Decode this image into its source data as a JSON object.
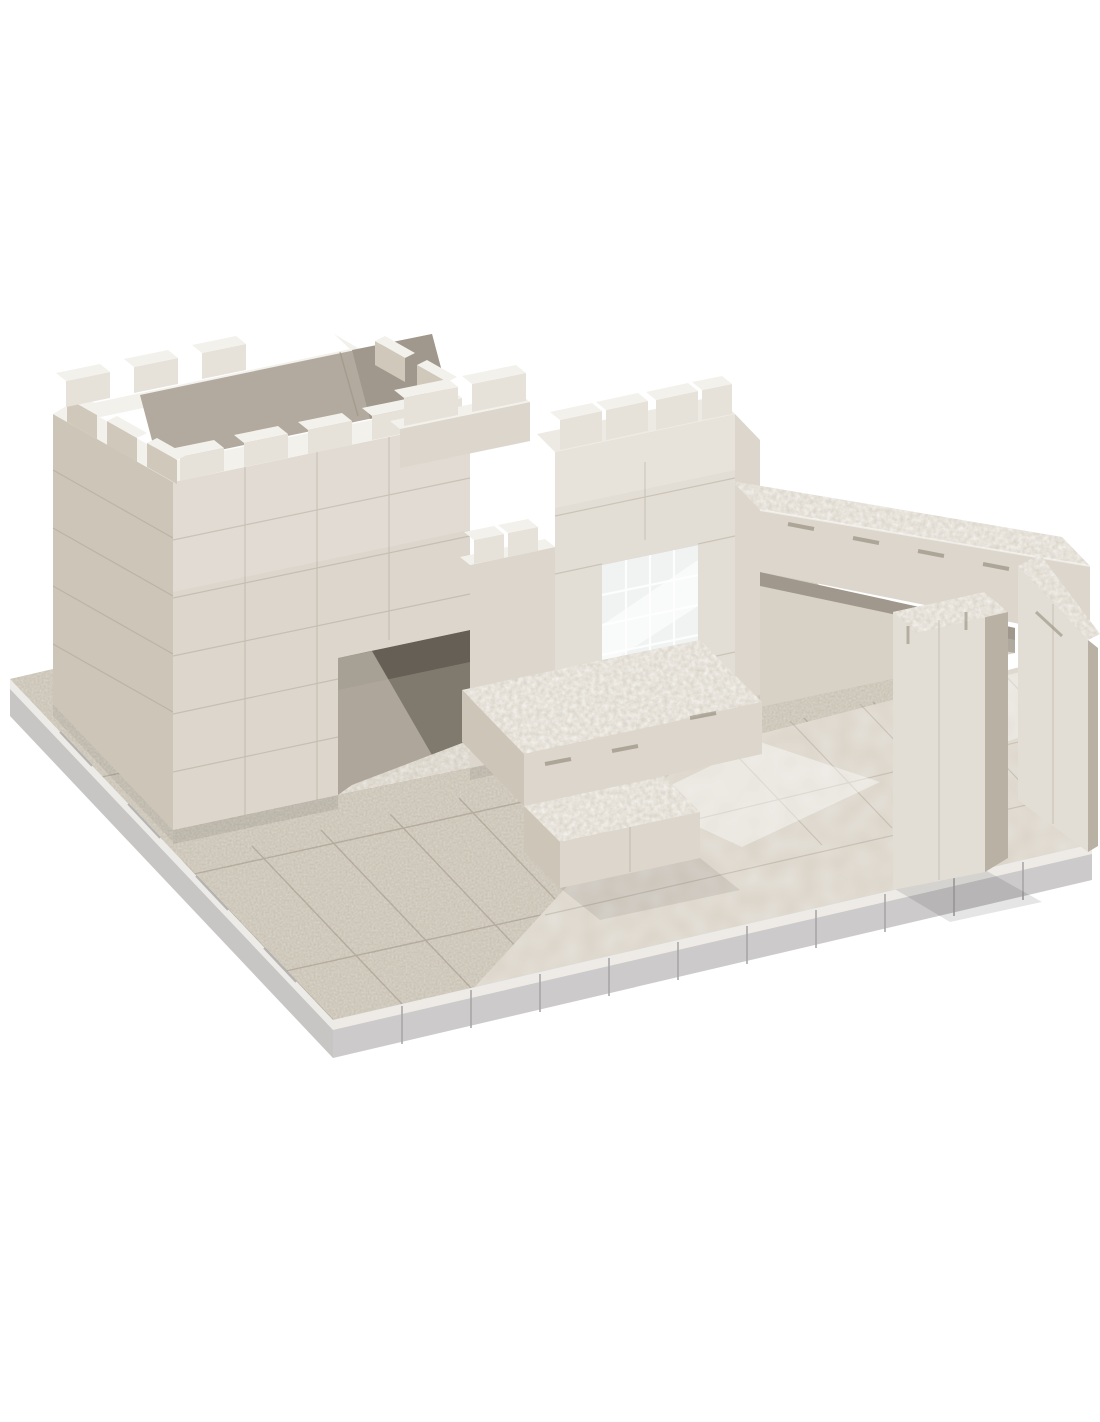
{
  "scene": {
    "type": "product-photo",
    "subject": "Cream architectural scale-model building kit: crenellated block walls, doorway, window, steps and pillar on a stone-textured baseplate",
    "background": "#ffffff"
  },
  "parts": {
    "baseplate": "stone-textured baseplate",
    "base_edge": "translucent base edge",
    "smooth_floor": "glossy interior floor tiles",
    "left_room": "open-top walled room",
    "doorway": "doorway opening",
    "parapet": "crenellated parapet",
    "tower": "central tower",
    "window": "glass-block window opening",
    "steps": "stone-topped platform and steps",
    "beam_wall": "rear beam wall with stone coping",
    "return_wall": "right return wall",
    "pillar": "freestanding pillar"
  },
  "colors": {
    "bg": "#ffffff",
    "wallFront": "#dcd6cc",
    "wallBright": "#e3ded5",
    "wallSide": "#cdc5b8",
    "wallSideDark": "#b9b1a4",
    "interiorDark": "#b2aa9e",
    "interiorDarker": "#a0988c",
    "capWhite": "#f3f1ec",
    "topFlat": "#edeae3",
    "merlonFace": "#e7e2d9",
    "merlonSide": "#d0c8bb",
    "stoneTop": "#d6cfc3",
    "apron": "#c5bdaf",
    "smoothFloor": "#d8d1c5",
    "glass": "#f1f2f2",
    "doorDark": "#80796d",
    "doorDarker": "#665f55",
    "mirror": "#beb6a9",
    "cobble": "#cfc8bb",
    "baseEdge": "#c8c6c5",
    "baseEdgeDark": "#a9a7a8",
    "seam": "#9e9485",
    "slotDark": "#87806f",
    "shadow": "#000000",
    "white": "#ffffff"
  }
}
